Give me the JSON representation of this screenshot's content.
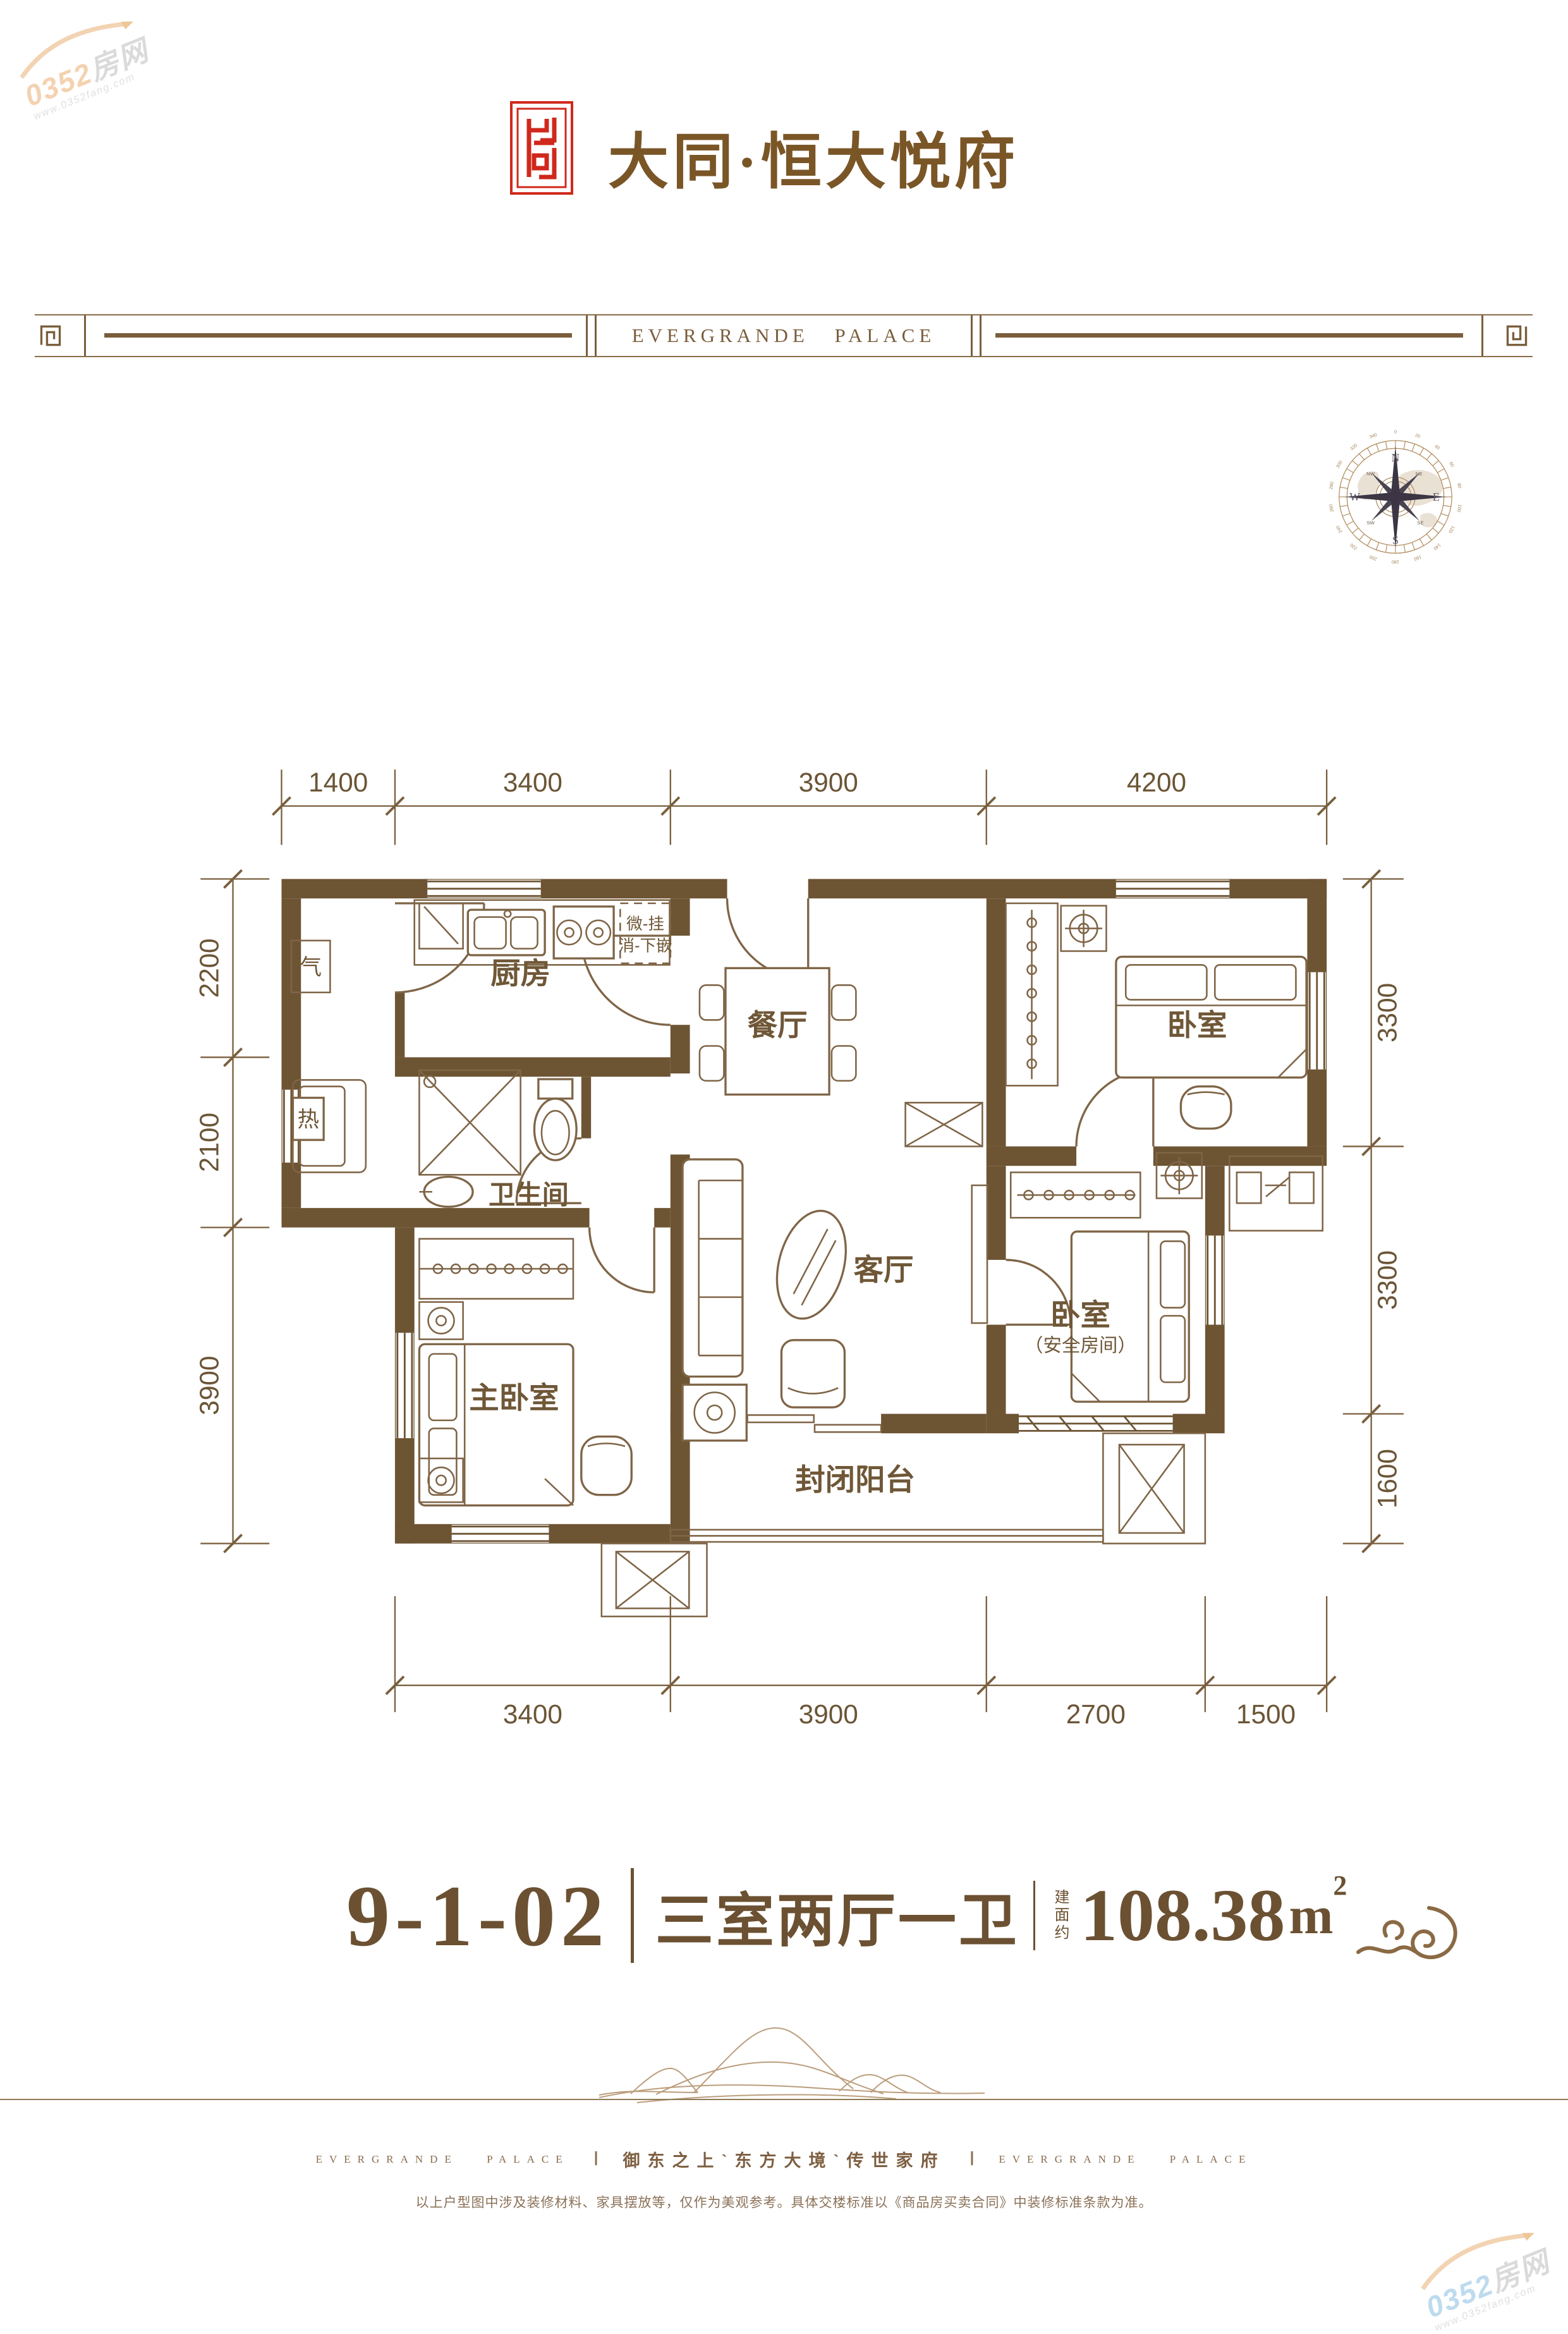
{
  "colors": {
    "wall_brown": "#6d5433",
    "text_brown": "#6b5536",
    "calligraphy_brown": "#7a5627",
    "seal_red": "#d0281c",
    "band_brown": "#7a5e3c",
    "footer_brown": "#8a6c4e",
    "mountain_tan": "#bb9d7c",
    "compass_star": "#3b3544",
    "watermark_orange": "#f2c79d",
    "watermark_blue": "#aed3ea"
  },
  "watermark": {
    "num": "0352",
    "cn": "房网",
    "url": "www.0352fang.com"
  },
  "header": {
    "title": "大同·恒大悦府",
    "band_text": "EVERGRANDE PALACE"
  },
  "compass": {
    "n": "N",
    "e": "E",
    "s": "S",
    "w": "W",
    "ne": "NE",
    "se": "SE",
    "sw": "SW",
    "nw": "NW",
    "degrees": [
      "0",
      "20",
      "40",
      "60",
      "80",
      "100",
      "120",
      "140",
      "160",
      "180",
      "200",
      "220",
      "240",
      "260",
      "280",
      "300",
      "320",
      "340"
    ]
  },
  "plan": {
    "dims": {
      "top": [
        "1400",
        "3400",
        "3900",
        "4200"
      ],
      "left": [
        "2200",
        "2100",
        "3900"
      ],
      "right": [
        "3300",
        "3300",
        "1600"
      ],
      "bottom": [
        "3400",
        "3900",
        "2700",
        "1500"
      ]
    },
    "rooms": {
      "kitchen": "厨房",
      "dining": "餐厅",
      "bedroom": "卧室",
      "bath": "卫生间",
      "living": "客厅",
      "master": "主卧室",
      "safe_bedroom": "卧室",
      "safe_bedroom_sub": "（安全房间）",
      "balcony": "封闭阳台"
    },
    "fixtures": {
      "gas": "气",
      "heater": "热",
      "micro1": "微-挂",
      "micro2": "消-下嵌"
    }
  },
  "unit": {
    "number": "9-1-02",
    "layout": "三室两厅一卫",
    "area_prefix": "建面约",
    "area": "108.38",
    "area_unit": "m",
    "area_sup": "2"
  },
  "footer": {
    "brand": "EVERGRANDE PALACE",
    "divider": "Ⅰ",
    "slogan": "御东之上ˋ东方大境ˋ传世家府",
    "disclaimer": "以上户型图中涉及装修材料、家具摆放等，仅作为美观参考。具体交楼标准以《商品房买卖合同》中装修标准条款为准。"
  }
}
